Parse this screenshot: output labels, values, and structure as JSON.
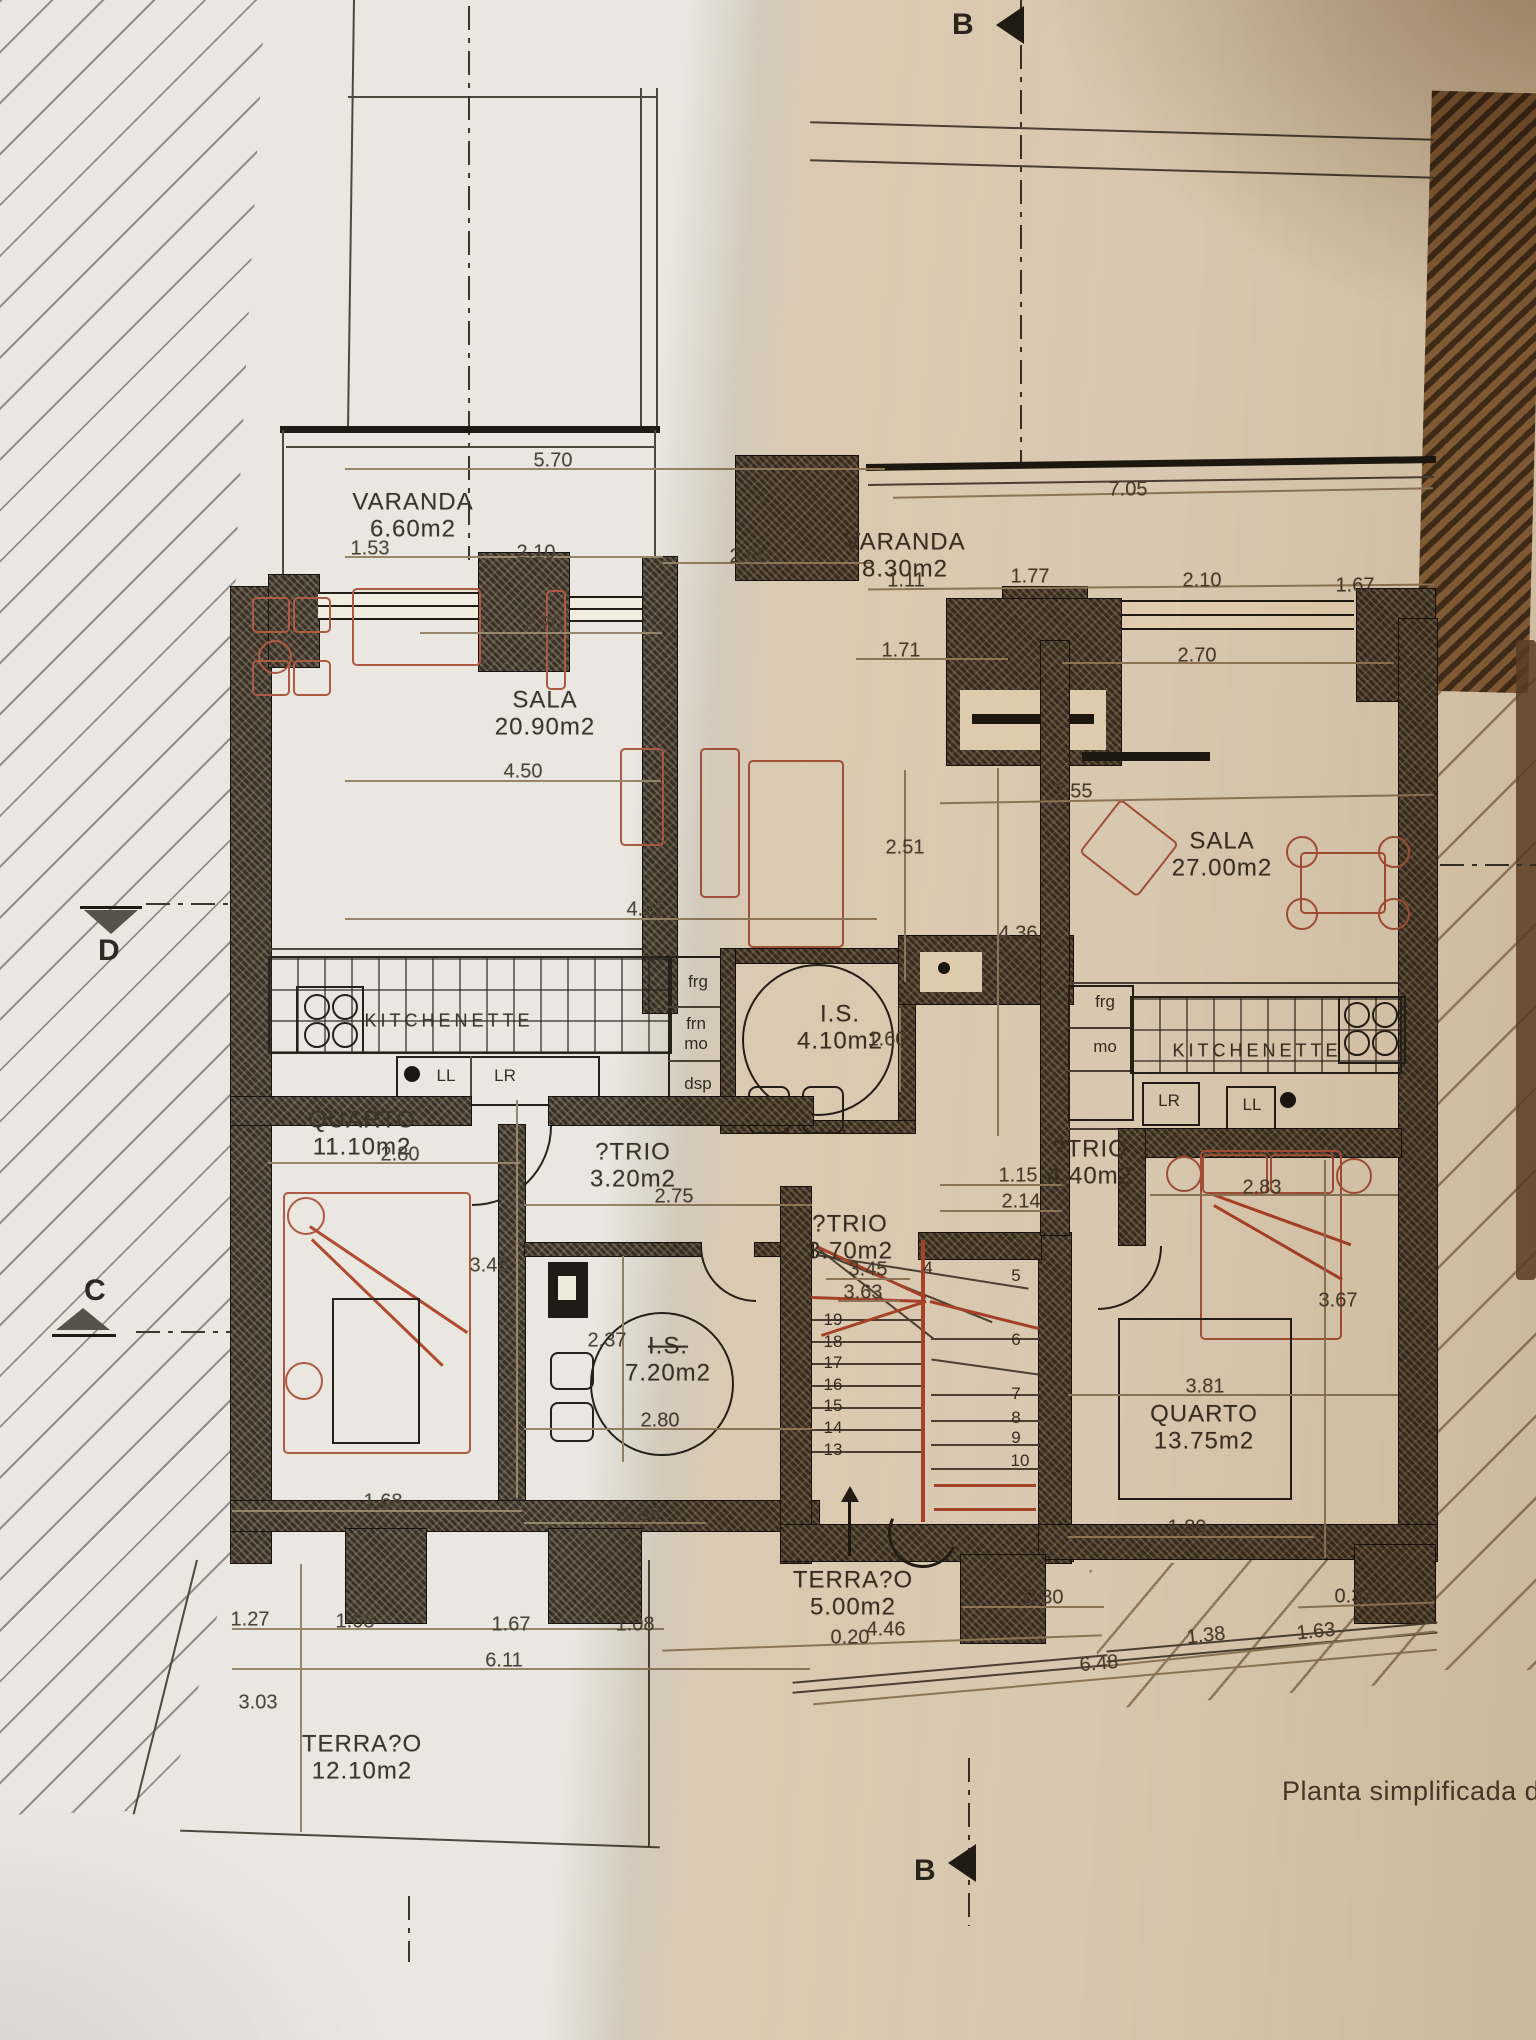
{
  "title": "Planta simplificada d",
  "section_markers": {
    "top": "B",
    "bottom": "B",
    "left_upper": "D",
    "left_lower": "C"
  },
  "room_labels": [
    {
      "name": "VARANDA",
      "area": "6.60m2",
      "x": 413,
      "y": 516
    },
    {
      "name": "VARANDA",
      "area": "8.30m2",
      "x": 905,
      "y": 556
    },
    {
      "name": "SALA",
      "area": "20.90m2",
      "x": 545,
      "y": 714
    },
    {
      "name": "SALA",
      "area": "27.00m2",
      "x": 1222,
      "y": 855
    },
    {
      "name": "KITCHENETTE",
      "x": 449,
      "y": 1021,
      "kind": "kitchen"
    },
    {
      "name": "KITCHENETTE",
      "x": 1257,
      "y": 1051,
      "kind": "kitchen"
    },
    {
      "name": "I.S.",
      "area": "4.10m2",
      "x": 840,
      "y": 1028
    },
    {
      "name": "QUARTO",
      "area": "11.10m2",
      "x": 362,
      "y": 1134
    },
    {
      "name": "?TRIO",
      "area": "3.20m2",
      "x": 633,
      "y": 1166
    },
    {
      "name": "?TRIO",
      "area": "4.40m2",
      "x": 1090,
      "y": 1163
    },
    {
      "name": "?TRIO",
      "area": "3.70m2",
      "x": 850,
      "y": 1238
    },
    {
      "name": "I.S.",
      "area": "7.20m2",
      "x": 668,
      "y": 1360,
      "struck": true
    },
    {
      "name": "QUARTO",
      "area": "13.75m2",
      "x": 1204,
      "y": 1428
    },
    {
      "name": "TERRA?O",
      "area": "5.00m2",
      "x": 853,
      "y": 1594
    },
    {
      "name": "TERRA?O",
      "area": "12.10m2",
      "x": 362,
      "y": 1758
    }
  ],
  "fixture_labels": [
    {
      "t": "frg",
      "x": 698,
      "y": 982
    },
    {
      "t": "frn",
      "x": 696,
      "y": 1024
    },
    {
      "t": "mo",
      "x": 696,
      "y": 1044
    },
    {
      "t": "dsp",
      "x": 698,
      "y": 1084
    },
    {
      "t": "LL",
      "x": 446,
      "y": 1076
    },
    {
      "t": "LR",
      "x": 505,
      "y": 1076
    },
    {
      "t": "frg",
      "x": 1105,
      "y": 1002
    },
    {
      "t": "mo",
      "x": 1105,
      "y": 1047
    },
    {
      "t": "LR",
      "x": 1169,
      "y": 1101
    },
    {
      "t": "LL",
      "x": 1252,
      "y": 1105
    }
  ],
  "dimension_labels": [
    {
      "t": "5.70",
      "x": 553,
      "y": 461
    },
    {
      "t": "7.05",
      "x": 1128,
      "y": 490
    },
    {
      "t": "1.53",
      "x": 370,
      "y": 549
    },
    {
      "t": "2.10",
      "x": 536,
      "y": 553
    },
    {
      "t": "2.66",
      "x": 749,
      "y": 557
    },
    {
      "t": "1.11",
      "x": 906,
      "y": 581
    },
    {
      "t": "1.77",
      "x": 1030,
      "y": 577
    },
    {
      "t": "2.10",
      "x": 1202,
      "y": 581
    },
    {
      "t": "1.67",
      "x": 1355,
      "y": 586
    },
    {
      "t": "2.70",
      "x": 543,
      "y": 625
    },
    {
      "t": "1.71",
      "x": 901,
      "y": 651
    },
    {
      "t": "2.70",
      "x": 1197,
      "y": 656
    },
    {
      "t": "4.50",
      "x": 523,
      "y": 772
    },
    {
      "t": "2.51",
      "x": 905,
      "y": 848
    },
    {
      "t": "7.55",
      "x": 1073,
      "y": 792
    },
    {
      "t": "4.21",
      "x": 646,
      "y": 910
    },
    {
      "t": "4.36",
      "x": 1018,
      "y": 934
    },
    {
      "t": "1.60",
      "x": 887,
      "y": 1040
    },
    {
      "t": "2.80",
      "x": 400,
      "y": 1155
    },
    {
      "t": "2.75",
      "x": 674,
      "y": 1197
    },
    {
      "t": "1.15",
      "x": 1018,
      "y": 1176
    },
    {
      "t": "2.14",
      "x": 1021,
      "y": 1202
    },
    {
      "t": "2.83",
      "x": 1262,
      "y": 1188
    },
    {
      "t": "3.48",
      "x": 489,
      "y": 1266
    },
    {
      "t": "3.45",
      "x": 868,
      "y": 1270
    },
    {
      "t": "3.63",
      "x": 863,
      "y": 1293
    },
    {
      "t": "3.67",
      "x": 1338,
      "y": 1301
    },
    {
      "t": "2.37",
      "x": 607,
      "y": 1341
    },
    {
      "t": "2.80",
      "x": 660,
      "y": 1421
    },
    {
      "t": "3.81",
      "x": 1205,
      "y": 1387
    },
    {
      "t": "1.68",
      "x": 383,
      "y": 1502
    },
    {
      "t": "1.68",
      "x": 641,
      "y": 1515
    },
    {
      "t": "1.89",
      "x": 1187,
      "y": 1528
    },
    {
      "t": "0.30",
      "x": 1044,
      "y": 1598
    },
    {
      "t": "0.37",
      "x": 1354,
      "y": 1597
    },
    {
      "t": "1.27",
      "x": 250,
      "y": 1620
    },
    {
      "t": "1.08",
      "x": 355,
      "y": 1622
    },
    {
      "t": "1.67",
      "x": 511,
      "y": 1625
    },
    {
      "t": "1.08",
      "x": 635,
      "y": 1625
    },
    {
      "t": "0.20",
      "x": 850,
      "y": 1638
    },
    {
      "t": "4.46",
      "x": 886,
      "y": 1630
    },
    {
      "t": "1.38",
      "x": 1206,
      "y": 1636,
      "r": -6
    },
    {
      "t": "1.63",
      "x": 1316,
      "y": 1632,
      "r": -6
    },
    {
      "t": "6.11",
      "x": 504,
      "y": 1661
    },
    {
      "t": "6.48",
      "x": 1099,
      "y": 1664,
      "r": -5
    },
    {
      "t": "3.03",
      "x": 258,
      "y": 1703
    }
  ],
  "stair_numbers": [
    {
      "t": "19",
      "x": 833,
      "y": 1320
    },
    {
      "t": "18",
      "x": 833,
      "y": 1342
    },
    {
      "t": "17",
      "x": 833,
      "y": 1363
    },
    {
      "t": "16",
      "x": 833,
      "y": 1385
    },
    {
      "t": "15",
      "x": 833,
      "y": 1406
    },
    {
      "t": "14",
      "x": 833,
      "y": 1428
    },
    {
      "t": "13",
      "x": 833,
      "y": 1450
    },
    {
      "t": "4",
      "x": 928,
      "y": 1268
    },
    {
      "t": "5",
      "x": 1016,
      "y": 1276
    },
    {
      "t": "6",
      "x": 1016,
      "y": 1340
    },
    {
      "t": "7",
      "x": 1016,
      "y": 1394
    },
    {
      "t": "8",
      "x": 1016,
      "y": 1418
    },
    {
      "t": "9",
      "x": 1016,
      "y": 1438
    },
    {
      "t": "10",
      "x": 1020,
      "y": 1461
    }
  ]
}
